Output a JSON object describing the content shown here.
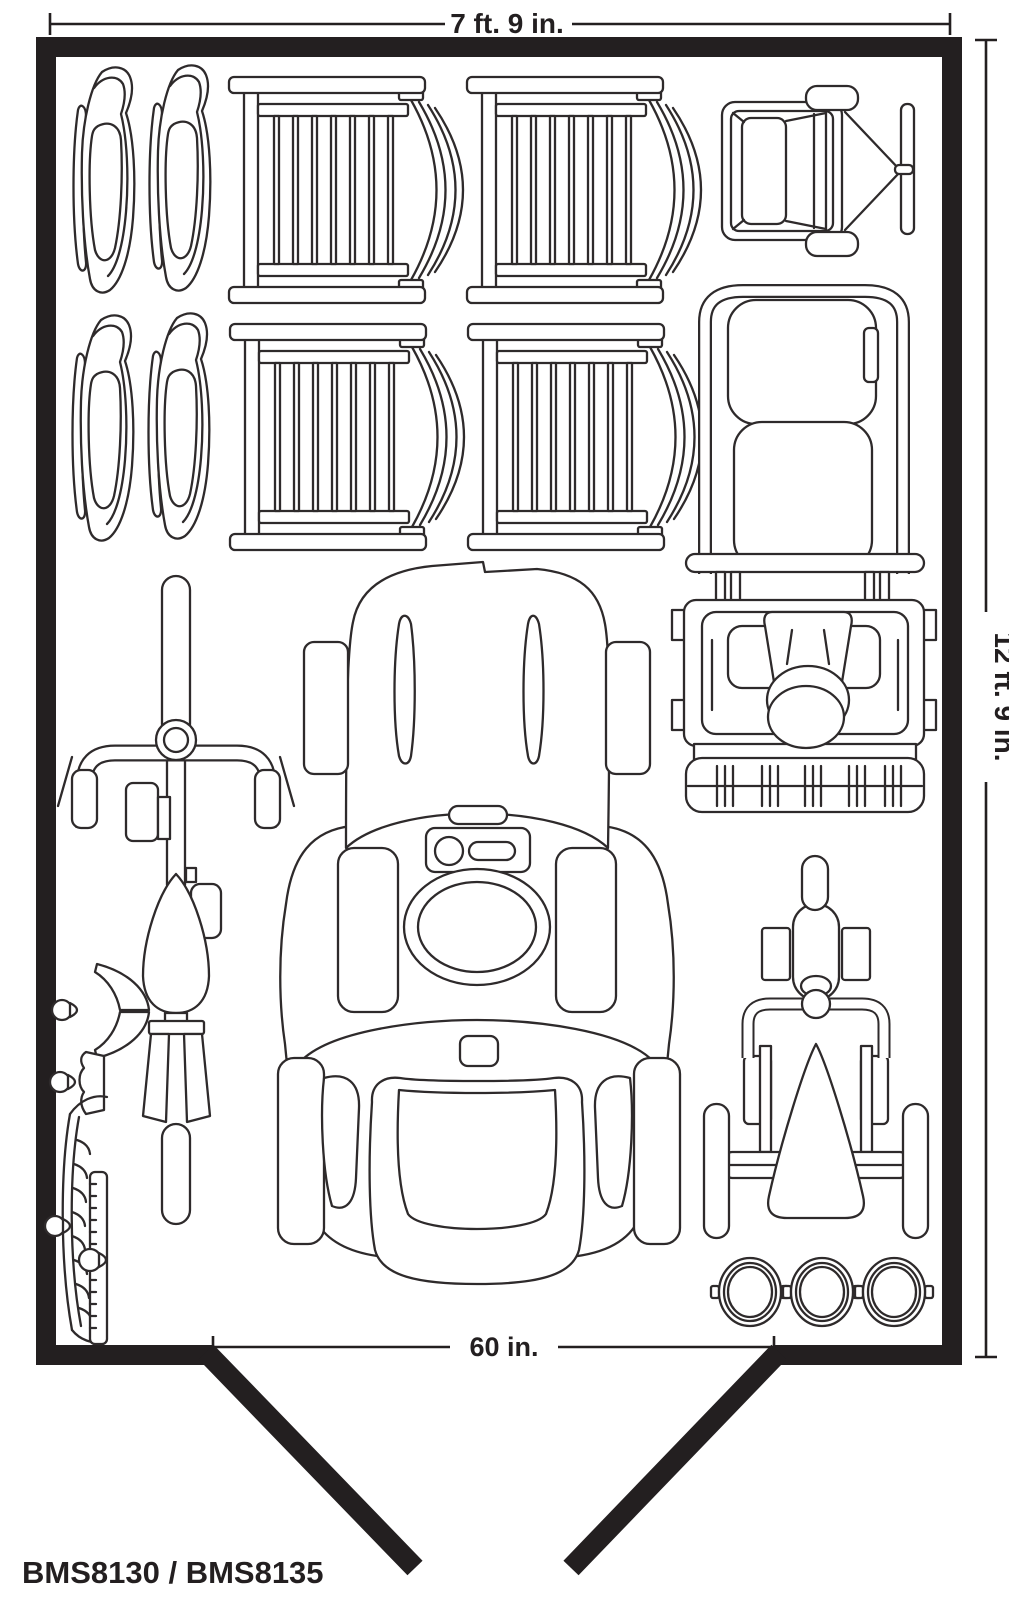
{
  "dimensions": {
    "top_width": "7 ft. 9 in.",
    "right_depth": "12 ft. 9 in.",
    "door_width": "60 in."
  },
  "model_label": "BMS8130 / BMS8135",
  "colors": {
    "wall": "#231f20",
    "line_art": "#2e2a2b",
    "background": "#ffffff"
  },
  "floor_plan": {
    "type": "storage-shed-floor-plan-top-view",
    "door": {
      "position": "bottom-center",
      "style": "double doors shown open outward"
    },
    "items": [
      {
        "name": "ski-sled",
        "count": 4,
        "location": "top-left, two rows of two"
      },
      {
        "name": "stacked-patio-chair",
        "count": 4,
        "location": "top-center, two rows of two"
      },
      {
        "name": "garden-dump-cart",
        "count": 1,
        "location": "top-right"
      },
      {
        "name": "hand-truck",
        "count": 1,
        "location": "upper-right"
      },
      {
        "name": "snow-blower",
        "count": 1,
        "location": "middle-right"
      },
      {
        "name": "riding-lawn-mower",
        "count": 1,
        "location": "center"
      },
      {
        "name": "bicycle",
        "count": 1,
        "location": "middle-left"
      },
      {
        "name": "garden-hand-tools",
        "count": 4,
        "location": "lower-left wall"
      },
      {
        "name": "pedal-go-kart",
        "count": 1,
        "location": "bottom-right"
      },
      {
        "name": "bucket",
        "count": 3,
        "location": "bottom-right corner"
      }
    ]
  }
}
